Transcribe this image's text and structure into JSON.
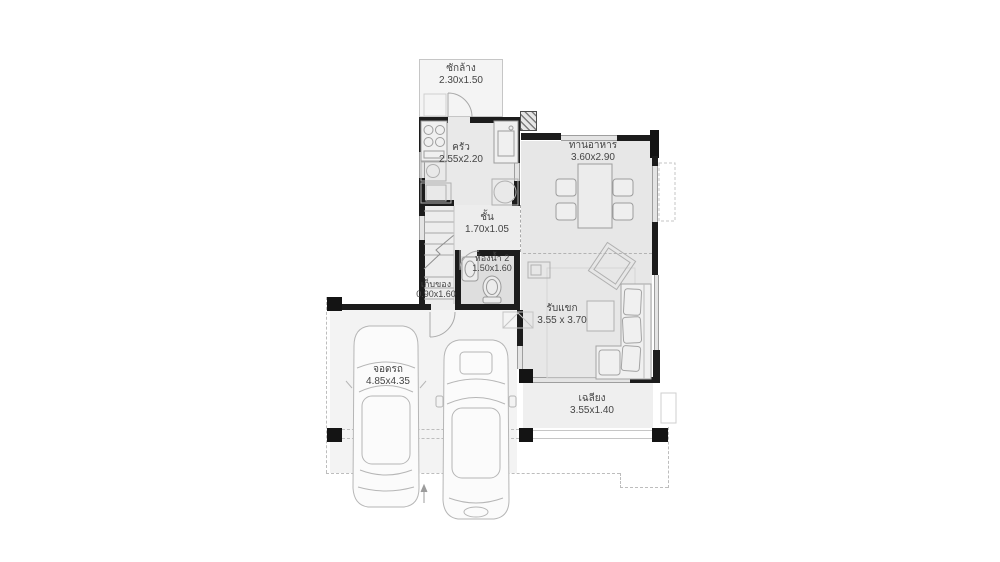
{
  "palette": {
    "wall": "#1c1c1c",
    "room_fill": "#e9e9e9",
    "outdoor_fill": "#f3f3f3",
    "furniture_line": "#b0b0b0",
    "text": "#454545"
  },
  "plan": {
    "rooms": [
      {
        "id": "laundry",
        "name": "ซักล้าง",
        "dims": "2.30x1.50"
      },
      {
        "id": "kitchen",
        "name": "ครัว",
        "dims": "2.55x2.20"
      },
      {
        "id": "dining",
        "name": "ทานอาหาร",
        "dims": "3.60x2.90"
      },
      {
        "id": "hall",
        "name": "ชั้น",
        "dims": "1.70x1.05"
      },
      {
        "id": "bath2",
        "name": "ห้องน้ำ 2",
        "dims": "1.50x1.60"
      },
      {
        "id": "storage",
        "name": "เก็บของ",
        "dims": "0.90x1.60"
      },
      {
        "id": "living",
        "name": "รับแขก",
        "dims": "3.55 x 3.70"
      },
      {
        "id": "porch",
        "name": "เฉลียง",
        "dims": "3.55x1.40"
      },
      {
        "id": "garage",
        "name": "จอดรถ",
        "dims": "4.85x4.35"
      }
    ]
  }
}
